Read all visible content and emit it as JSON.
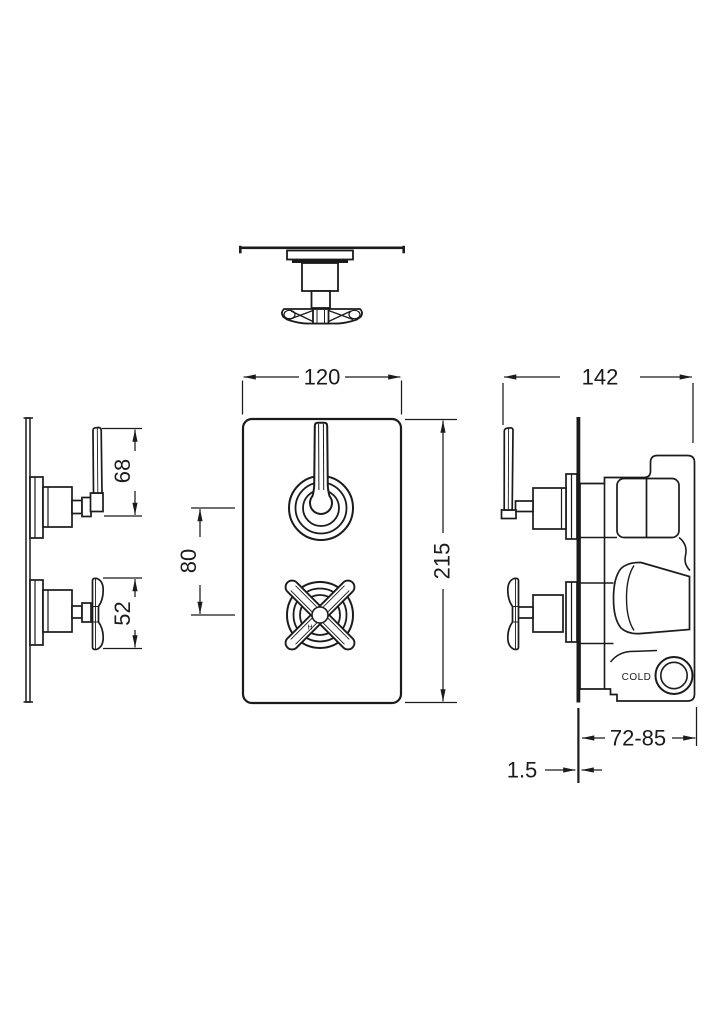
{
  "drawing": {
    "type": "technical-dimension-drawing",
    "subject": "twin concealed thermostatic shower valve",
    "views": [
      "top-view",
      "front-view",
      "side-view-left",
      "side-view-right"
    ]
  },
  "dimensions": {
    "front_width": "120",
    "front_height": "215",
    "handle_spacing": "80",
    "lever_handle_depth": "68",
    "cross_handle_depth": "52",
    "total_depth": "142",
    "recess_depth": "72-85",
    "plate_thickness": "1.5"
  },
  "labels": {
    "cold": "COLD",
    "hot_marker": "H"
  },
  "colors": {
    "background": "#ffffff",
    "line": "#1b1b1b"
  }
}
